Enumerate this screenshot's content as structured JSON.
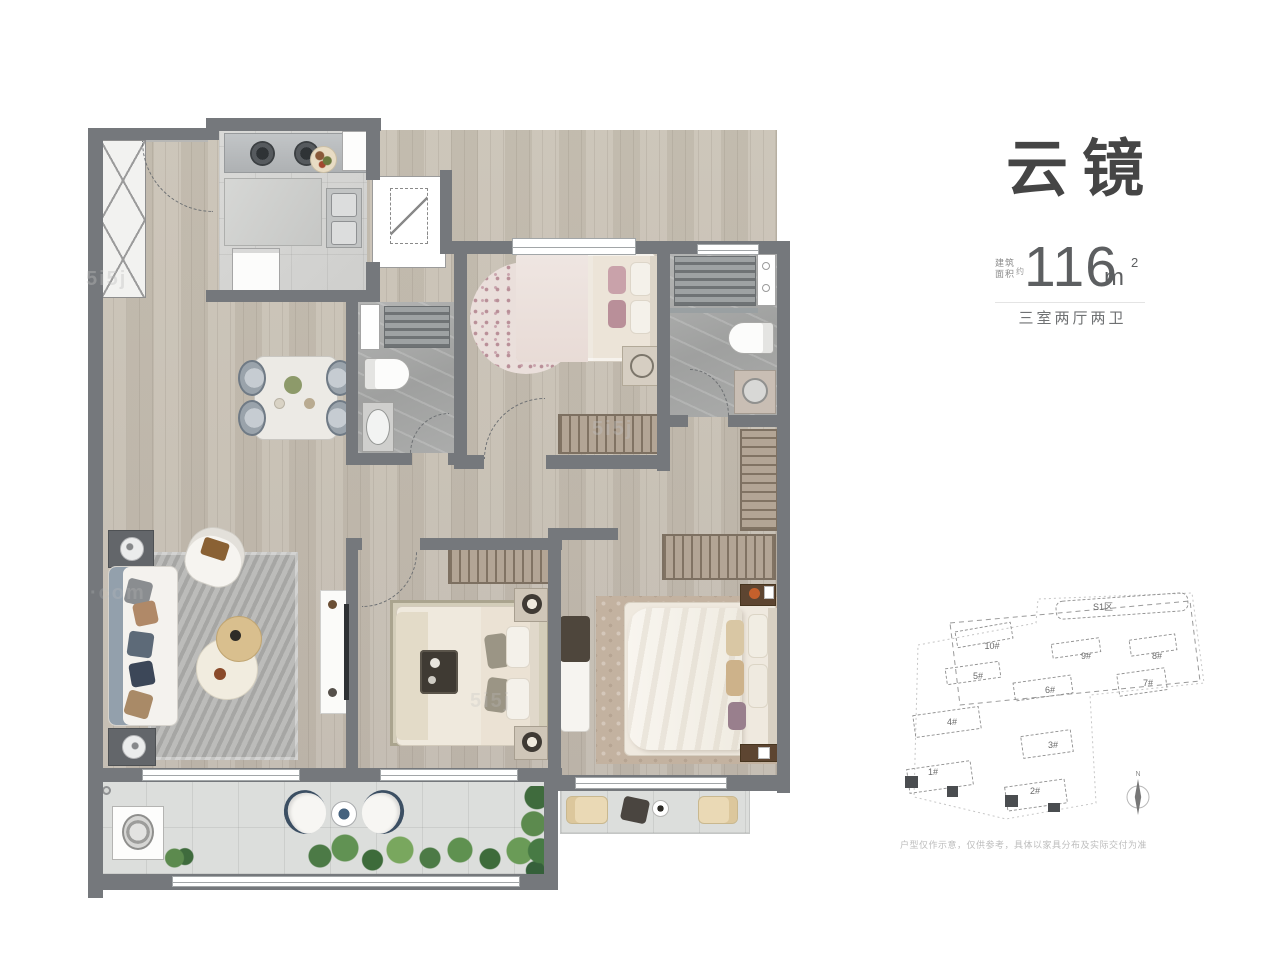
{
  "header": {
    "title": "云镜",
    "area_label_line1": "建筑",
    "area_label_line2": "面积",
    "area_approx": "约",
    "area_value": "116",
    "area_unit": "m",
    "area_unit_sup": "2",
    "layout_text": "三室两厅两卫"
  },
  "site_plan": {
    "zone_label": "S1区",
    "north_label": "N",
    "buildings": [
      {
        "label": "1#"
      },
      {
        "label": "2#"
      },
      {
        "label": "3#"
      },
      {
        "label": "4#"
      },
      {
        "label": "5#"
      },
      {
        "label": "6#"
      },
      {
        "label": "7#"
      },
      {
        "label": "8#"
      },
      {
        "label": "9#"
      },
      {
        "label": "10#"
      }
    ]
  },
  "watermark": {
    "text": "5i5j",
    "suffix": "·com"
  },
  "disclaimer": "户型仅作示意，仅供参考，具体以家具分布及实际交付为准",
  "colors": {
    "wall": "#75787c",
    "wood_floor": "#c6bfb3",
    "bath_tile": "#a7a8a7",
    "kitchen_tile": "#d6d6d4",
    "balcony_tile": "#dcdedc",
    "title_text": "#454545",
    "secondary_text": "#6f7173",
    "pink_accent": "#c9a2aa",
    "highlight_unit": "#4a4d50"
  }
}
